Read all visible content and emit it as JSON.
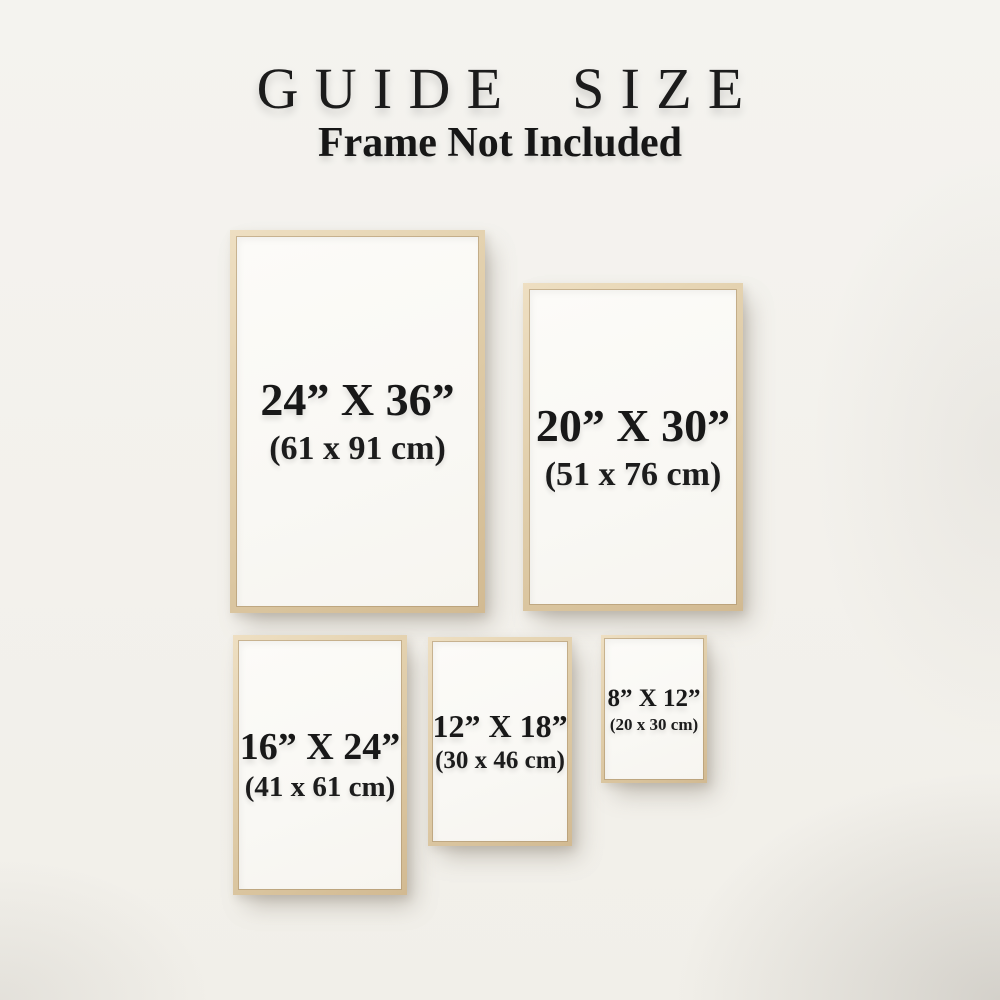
{
  "page": {
    "title": "GUIDE SIZE",
    "subtitle": "Frame Not Included"
  },
  "colors": {
    "background": "#f3f1ec",
    "frame_wood": "#ddc9a6",
    "frame_wood_light": "#eedfc2",
    "frame_wood_dark": "#d2ba92",
    "poster": "#faf9f5",
    "text": "#1b1b1b"
  },
  "frames": [
    {
      "id": "24x36",
      "inches": "24” X 36”",
      "cm": "(61 x 91 cm)"
    },
    {
      "id": "20x30",
      "inches": "20” X 30”",
      "cm": "(51 x 76 cm)"
    },
    {
      "id": "16x24",
      "inches": "16” X 24”",
      "cm": "(41 x 61 cm)"
    },
    {
      "id": "12x18",
      "inches": "12” X 18”",
      "cm": "(30 x 46 cm)"
    },
    {
      "id": "8x12",
      "inches": "8” X 12”",
      "cm": "(20 x 30 cm)"
    }
  ]
}
